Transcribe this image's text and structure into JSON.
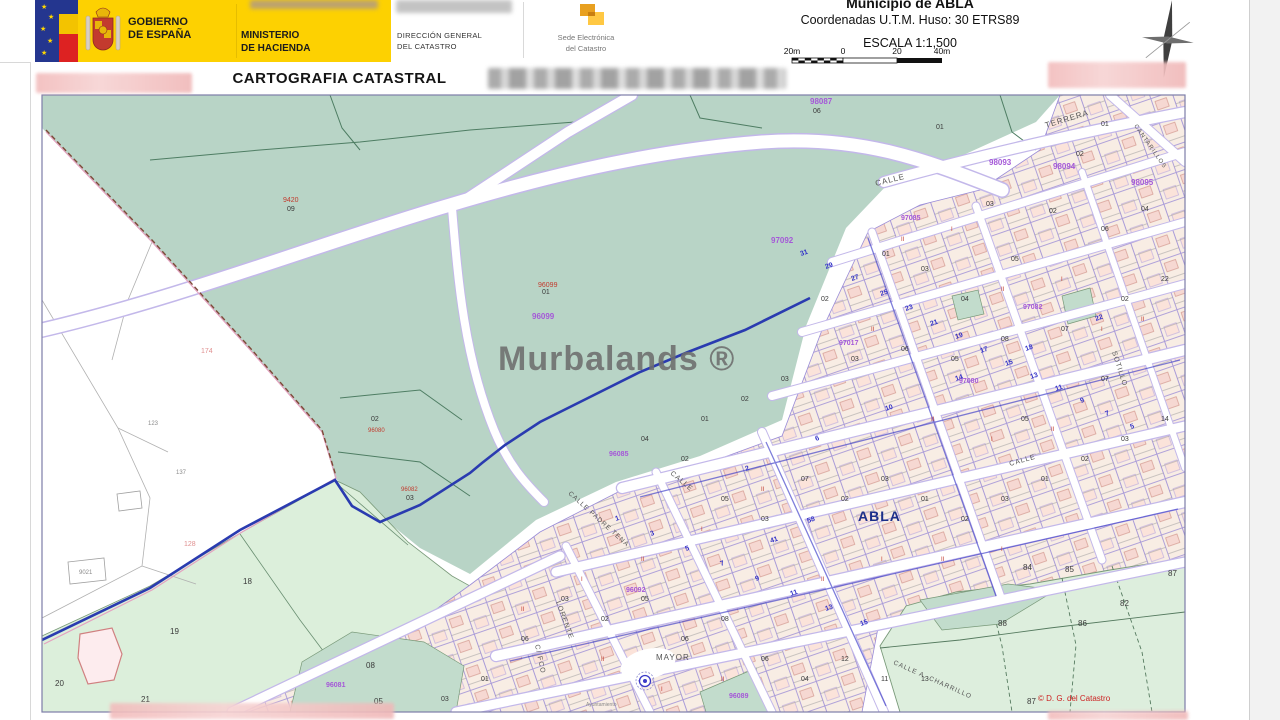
{
  "header": {
    "gobierno": [
      "GOBIERNO",
      "DE ESPAÑA"
    ],
    "ministerio": [
      "MINISTERIO",
      "DE HACIENDA"
    ],
    "direccion": [
      "DIRECCIÓN GENERAL",
      "DEL CATASTRO"
    ],
    "sede": [
      "Sede Electrónica",
      "del Catastro"
    ],
    "municipio": "Municipio de ABLA",
    "coordenadas": "Coordenadas U.T.M. Huso: 30 ETRS89",
    "escala": "ESCALA 1:1,500",
    "scale_labels": [
      "20m",
      "0",
      "20",
      "40m"
    ],
    "title": "CARTOGRAFIA CATASTRAL"
  },
  "map": {
    "watermark": "Murbalands ®",
    "town": "ABLA",
    "copyright": "© D. G. del Catastro",
    "labels": [
      [
        "9420",
        283,
        202,
        "red",
        7
      ],
      [
        "09",
        287,
        211,
        "blk",
        7
      ],
      [
        "96099",
        538,
        287,
        "red",
        7
      ],
      [
        "01",
        542,
        294,
        "blk",
        7
      ],
      [
        "96099",
        532,
        319,
        "pur",
        8
      ],
      [
        "02",
        371,
        421,
        "blk",
        7
      ],
      [
        "96080",
        368,
        432,
        "red",
        6
      ],
      [
        "96082",
        401,
        491,
        "red",
        6
      ],
      [
        "03",
        406,
        500,
        "blk",
        7
      ],
      [
        "174",
        201,
        353,
        "pnk",
        7
      ],
      [
        "128",
        184,
        546,
        "pnk",
        7
      ],
      [
        "123",
        148,
        425,
        "gry",
        6
      ],
      [
        "137",
        176,
        474,
        "gry",
        6
      ],
      [
        "9021",
        79,
        574,
        "gry",
        6
      ],
      [
        "18",
        243,
        584,
        "blk",
        8
      ],
      [
        "19",
        170,
        634,
        "blk",
        8
      ],
      [
        "20",
        55,
        686,
        "blk",
        8
      ],
      [
        "21",
        141,
        702,
        "blk",
        8
      ],
      [
        "98087",
        810,
        104,
        "pur",
        8
      ],
      [
        "06",
        813,
        113,
        "blk",
        7
      ],
      [
        "84",
        1023,
        570,
        "blk",
        8
      ],
      [
        "85",
        1065,
        572,
        "blk",
        8
      ],
      [
        "87",
        1168,
        576,
        "blk",
        8
      ],
      [
        "82",
        1120,
        606,
        "blk",
        8
      ],
      [
        "86",
        1078,
        626,
        "blk",
        8
      ],
      [
        "88",
        998,
        626,
        "blk",
        8
      ],
      [
        "87",
        1027,
        704,
        "blk",
        8
      ],
      [
        "08",
        366,
        668,
        "blk",
        8
      ],
      [
        "05",
        374,
        704,
        "blk",
        8
      ],
      [
        "96081",
        326,
        687,
        "pur",
        7
      ],
      [
        "CALLE",
        876,
        186,
        "str",
        8,
        -14
      ],
      [
        "TERRERA",
        1046,
        128,
        "str",
        8,
        -17
      ],
      [
        "CANTARILLOS",
        1134,
        126,
        "str",
        6,
        55
      ],
      [
        "SOTILLO",
        1112,
        352,
        "str",
        7,
        72
      ],
      [
        "CALLE",
        670,
        474,
        "str",
        7,
        40
      ],
      [
        "CALLE PADRE TENA",
        568,
        494,
        "str",
        6.5,
        42
      ],
      [
        "LORENTE",
        556,
        602,
        "str",
        7,
        70
      ],
      [
        "C/ FCO",
        535,
        645,
        "str",
        7,
        78
      ],
      [
        "MAYOR",
        656,
        660,
        "str",
        8
      ],
      [
        "CALLE A. CHARRILLO",
        893,
        664,
        "str",
        6.5,
        24
      ],
      [
        "Ayuntamiento",
        586,
        706,
        "gry",
        5
      ],
      [
        "CALLE",
        1010,
        466,
        "str",
        7,
        -16
      ],
      [
        "98093",
        989,
        165,
        "pur",
        8
      ],
      [
        "98094",
        1053,
        169,
        "pur",
        8
      ],
      [
        "98095",
        1131,
        185,
        "pur",
        8
      ],
      [
        "97085",
        901,
        220,
        "pur",
        7
      ],
      [
        "97092",
        771,
        243,
        "pur",
        8
      ],
      [
        "97017",
        839,
        345,
        "pur",
        7
      ],
      [
        "96092",
        626,
        592,
        "pur",
        7
      ],
      [
        "96085",
        609,
        456,
        "pur",
        7
      ],
      [
        "97080",
        959,
        383,
        "pur",
        7
      ],
      [
        "96089",
        729,
        698,
        "pur",
        7
      ],
      [
        "97082",
        1023,
        309,
        "pur",
        7
      ],
      [
        "01",
        936,
        129,
        "blk",
        7
      ],
      [
        "01",
        1101,
        126,
        "blk",
        7
      ],
      [
        "02",
        1076,
        156,
        "blk",
        7
      ],
      [
        "03",
        986,
        206,
        "blk",
        7
      ],
      [
        "02",
        1049,
        213,
        "blk",
        7
      ],
      [
        "01",
        882,
        256,
        "blk",
        7
      ],
      [
        "03",
        921,
        271,
        "blk",
        7
      ],
      [
        "04",
        961,
        301,
        "blk",
        7
      ],
      [
        "05",
        1011,
        261,
        "blk",
        7
      ],
      [
        "06",
        1101,
        231,
        "blk",
        7
      ],
      [
        "04",
        1141,
        211,
        "blk",
        7
      ],
      [
        "02",
        821,
        301,
        "blk",
        7
      ],
      [
        "03",
        851,
        361,
        "blk",
        7
      ],
      [
        "06",
        901,
        351,
        "blk",
        7
      ],
      [
        "05",
        951,
        361,
        "blk",
        7
      ],
      [
        "08",
        1001,
        341,
        "blk",
        7
      ],
      [
        "07",
        1061,
        331,
        "blk",
        7
      ],
      [
        "02",
        1121,
        301,
        "blk",
        7
      ],
      [
        "22",
        1161,
        281,
        "blk",
        7
      ],
      [
        "01",
        701,
        421,
        "blk",
        7
      ],
      [
        "02",
        741,
        401,
        "blk",
        7
      ],
      [
        "03",
        781,
        381,
        "blk",
        7
      ],
      [
        "04",
        641,
        441,
        "blk",
        7
      ],
      [
        "02",
        681,
        461,
        "blk",
        7
      ],
      [
        "05",
        721,
        501,
        "blk",
        7
      ],
      [
        "03",
        761,
        521,
        "blk",
        7
      ],
      [
        "07",
        801,
        481,
        "blk",
        7
      ],
      [
        "02",
        841,
        501,
        "blk",
        7
      ],
      [
        "03",
        881,
        481,
        "blk",
        7
      ],
      [
        "01",
        921,
        501,
        "blk",
        7
      ],
      [
        "02",
        961,
        521,
        "blk",
        7
      ],
      [
        "03",
        1001,
        501,
        "blk",
        7
      ],
      [
        "01",
        1041,
        481,
        "blk",
        7
      ],
      [
        "02",
        1081,
        461,
        "blk",
        7
      ],
      [
        "03",
        1121,
        441,
        "blk",
        7
      ],
      [
        "14",
        1161,
        421,
        "blk",
        7
      ],
      [
        "03",
        561,
        601,
        "blk",
        7
      ],
      [
        "02",
        601,
        621,
        "blk",
        7
      ],
      [
        "05",
        641,
        601,
        "blk",
        7
      ],
      [
        "06",
        681,
        641,
        "blk",
        7
      ],
      [
        "08",
        721,
        621,
        "blk",
        7
      ],
      [
        "06",
        761,
        661,
        "blk",
        7
      ],
      [
        "04",
        801,
        681,
        "blk",
        7
      ],
      [
        "12",
        841,
        661,
        "blk",
        7
      ],
      [
        "11",
        881,
        681,
        "blk",
        7
      ],
      [
        "13",
        921,
        681,
        "blk",
        7
      ],
      [
        "06",
        521,
        641,
        "blk",
        7
      ],
      [
        "01",
        481,
        681,
        "blk",
        7
      ],
      [
        "03",
        441,
        701,
        "blk",
        7
      ],
      [
        "05",
        1021,
        421,
        "blk",
        7
      ],
      [
        "07",
        1101,
        381,
        "blk",
        7
      ],
      [
        "23",
        906,
        311,
        "blu",
        7,
        -19
      ],
      [
        "21",
        931,
        326,
        "blu",
        7,
        -19
      ],
      [
        "19",
        956,
        339,
        "blu",
        7,
        -19
      ],
      [
        "25",
        881,
        296,
        "blu",
        7,
        -19
      ],
      [
        "27",
        852,
        281,
        "blu",
        7,
        -19
      ],
      [
        "29",
        826,
        269,
        "blu",
        7,
        -19
      ],
      [
        "31",
        801,
        256,
        "blu",
        7,
        -19
      ],
      [
        "17",
        981,
        353,
        "blu",
        7,
        -19
      ],
      [
        "15",
        1006,
        366,
        "blu",
        7,
        -19
      ],
      [
        "13",
        1031,
        379,
        "blu",
        7,
        -19
      ],
      [
        "11",
        1056,
        391,
        "blu",
        7,
        -19
      ],
      [
        "9",
        1081,
        403,
        "blu",
        7,
        -19
      ],
      [
        "7",
        1106,
        416,
        "blu",
        7,
        -19
      ],
      [
        "5",
        1131,
        429,
        "blu",
        7,
        -19
      ],
      [
        "1",
        616,
        521,
        "blu",
        7,
        -19
      ],
      [
        "3",
        651,
        536,
        "blu",
        7,
        -19
      ],
      [
        "5",
        686,
        551,
        "blu",
        7,
        -19
      ],
      [
        "7",
        721,
        566,
        "blu",
        7,
        -19
      ],
      [
        "9",
        756,
        581,
        "blu",
        7,
        -19
      ],
      [
        "11",
        791,
        596,
        "blu",
        7,
        -19
      ],
      [
        "13",
        826,
        611,
        "blu",
        7,
        -19
      ],
      [
        "15",
        861,
        626,
        "blu",
        7,
        -19
      ],
      [
        "2",
        746,
        471,
        "blu",
        7,
        -19
      ],
      [
        "6",
        816,
        441,
        "blu",
        7,
        -19
      ],
      [
        "10",
        886,
        411,
        "blu",
        7,
        -19
      ],
      [
        "14",
        956,
        381,
        "blu",
        7,
        -19
      ],
      [
        "18",
        1026,
        351,
        "blu",
        7,
        -19
      ],
      [
        "22",
        1096,
        321,
        "blu",
        7,
        -19
      ],
      [
        "58",
        808,
        523,
        "blu",
        7,
        -19
      ],
      [
        "41",
        771,
        543,
        "blu",
        7,
        -19
      ],
      [
        "II",
        901,
        241,
        "red",
        6
      ],
      [
        "I",
        951,
        231,
        "red",
        6
      ],
      [
        "II",
        1001,
        291,
        "red",
        6
      ],
      [
        "I",
        1061,
        281,
        "red",
        6
      ],
      [
        "II",
        871,
        331,
        "red",
        6
      ],
      [
        "II",
        931,
        421,
        "red",
        6
      ],
      [
        "I",
        991,
        441,
        "red",
        6
      ],
      [
        "II",
        1051,
        431,
        "red",
        6
      ],
      [
        "II",
        761,
        491,
        "red",
        6
      ],
      [
        "I",
        701,
        531,
        "red",
        6
      ],
      [
        "II",
        641,
        561,
        "red",
        6
      ],
      [
        "I",
        581,
        581,
        "red",
        6
      ],
      [
        "II",
        821,
        581,
        "red",
        6
      ],
      [
        "I",
        881,
        561,
        "red",
        6
      ],
      [
        "II",
        941,
        561,
        "red",
        6
      ],
      [
        "I",
        1001,
        551,
        "red",
        6
      ],
      [
        "II",
        521,
        611,
        "red",
        6
      ],
      [
        "II",
        601,
        661,
        "red",
        6
      ],
      [
        "I",
        661,
        691,
        "red",
        6
      ],
      [
        "II",
        721,
        681,
        "red",
        6
      ],
      [
        "I",
        1101,
        331,
        "red",
        6
      ],
      [
        "II",
        1141,
        321,
        "red",
        6
      ]
    ]
  },
  "colors": {
    "header_yellow": "#fdd101",
    "sage_green": "#b8d4c6",
    "light_green": "#dcefdb",
    "parcel_cream": "#f8ede4",
    "parcel_pink": "#f6d8d2",
    "boundary_navy": "#2a3bb0",
    "street_casing": "#c3b8ea",
    "label_purple": "#a558d8",
    "label_blue": "#3434c8",
    "label_red": "#c23b2e"
  }
}
